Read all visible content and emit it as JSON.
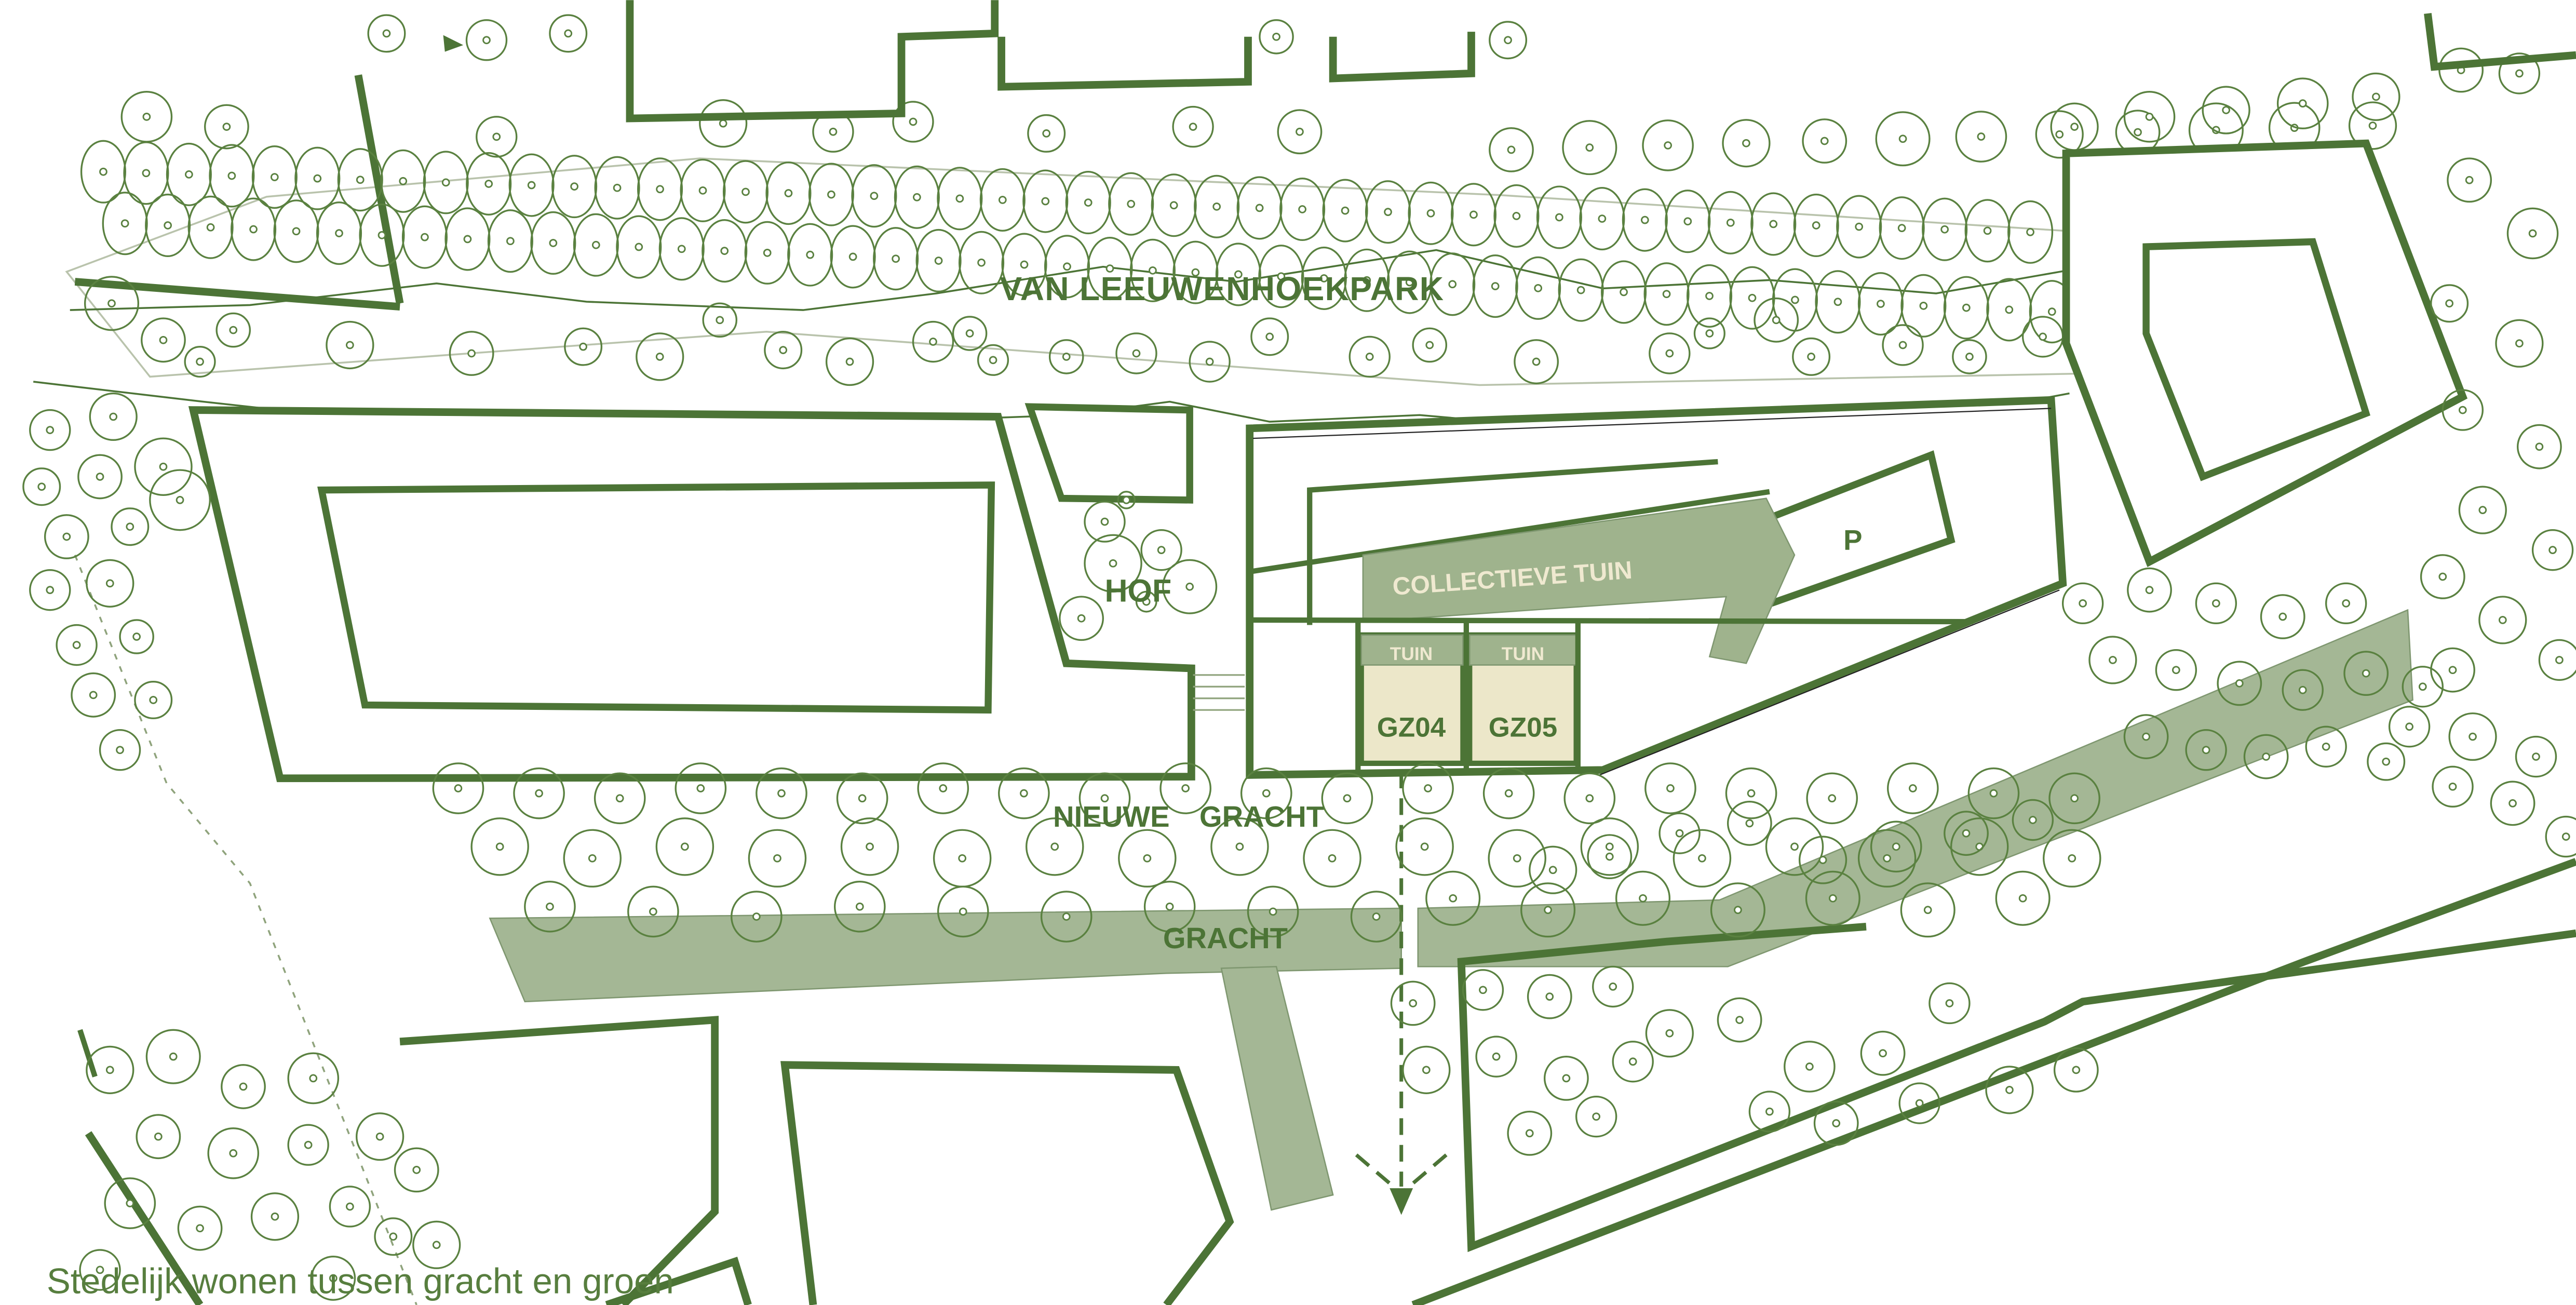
{
  "labels": {
    "park": "VAN LEEUWENHOEKPARK",
    "hof": "HOF",
    "collective_garden": "COLLECTIEVE TUIN",
    "tuin_left": "TUIN",
    "tuin_right": "TUIN",
    "gz04": "GZ04",
    "gz05": "GZ05",
    "parking": "P",
    "nieuwe_gracht": "NIEUWE GRACHT",
    "gracht": "GRACHT"
  },
  "caption": "Stedelijk wonen tussen gracht en groen",
  "colors": {
    "outline": "#4C7436",
    "tree": "#5A8140",
    "sage": "#9FB38D",
    "band": "#A4B795",
    "beige": "#ECE7C9",
    "cream": "#EFE9D0",
    "caption_text": "#577E3E",
    "park_boundary": "#B9C3AC"
  }
}
